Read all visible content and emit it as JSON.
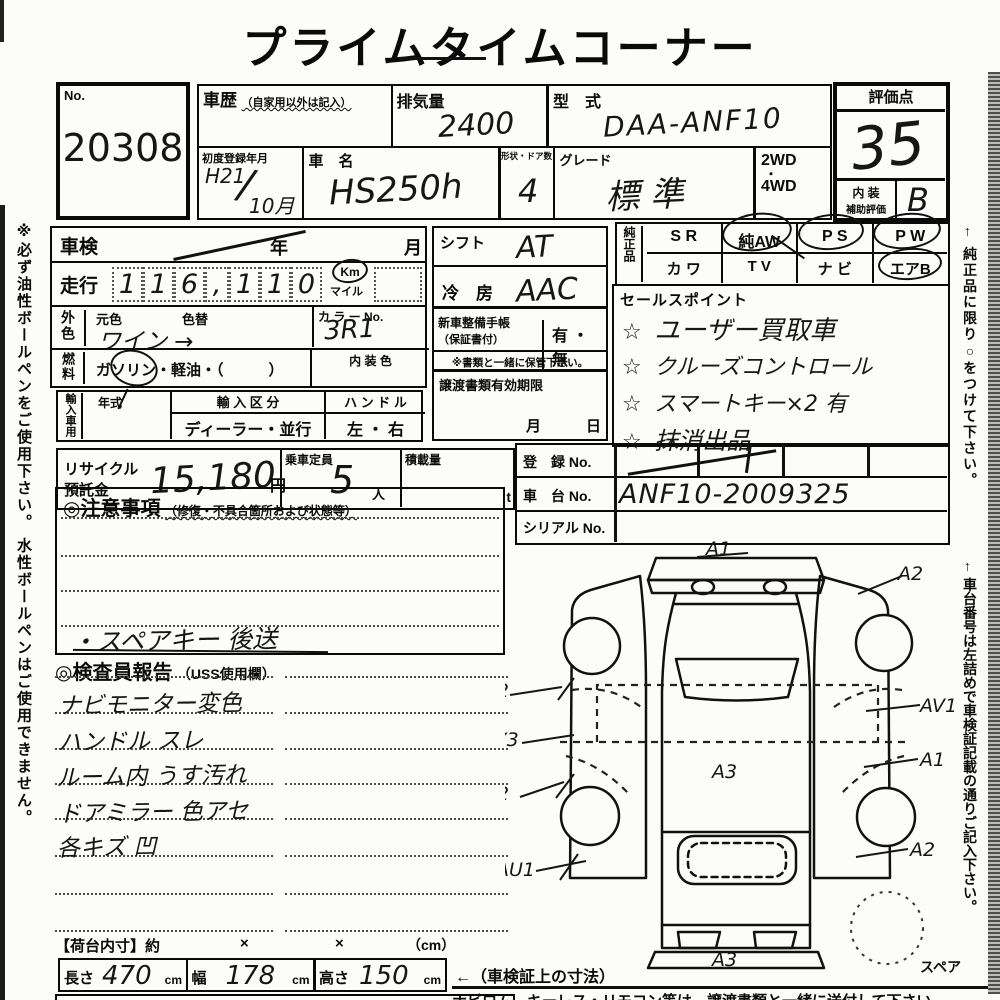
{
  "title": "プライムタイムコーナー",
  "side_notes": {
    "left": "※必ず油性ボールペンをご使用下さい。 水性ボールペンはご使用できません。",
    "right_genuine": "← 純正品に限り○をつけて下さい。",
    "right_chassis": "← 車台番号は左詰めで車検証記載の通りご記入下さい。"
  },
  "header": {
    "no_label": "No.",
    "no_value": "20308",
    "history_label": "車歴",
    "history_note": "（自家用以外は記入）",
    "displacement_label": "排気量",
    "displacement_value": "2400",
    "model_code_label": "型　式",
    "model_code_value": "DAA-ANF10",
    "first_reg_label": "初度登録年月",
    "first_reg_era_year": "H21",
    "first_reg_slash": "/",
    "first_reg_month": "10月",
    "car_name_label": "車　名",
    "car_name_value": "HS250h",
    "shape_doors_label": "形状・ドア数",
    "shape_doors_value": "4",
    "grade_label": "グレード",
    "grade_value": "標 準",
    "drive_top": "2WD",
    "drive_dot": "・",
    "drive_bottom": "4WD",
    "score_label": "評価点",
    "score_value": "35",
    "interior_label_line1": "内 装",
    "interior_label_line2": "補助評価",
    "interior_value": "B"
  },
  "left_panel": {
    "shaken_label": "車検",
    "year_label": "年",
    "month_label": "月",
    "mileage_label": "走行",
    "digits": [
      "1",
      "1",
      "6",
      ",",
      "1",
      "1",
      "0"
    ],
    "km_label": "Km",
    "mile_label": "マイル",
    "ext_color_label": "外色",
    "base_color_label": "元色",
    "base_color_value": "ワイン →",
    "color_change_label": "色替",
    "color_no_label": "カ ラ ー No.",
    "color_no_value": "3R1",
    "fuel_label": "燃料",
    "fuel_options": "ガソリン・軽油・（　　　）",
    "interior_color_label": "内 装 色",
    "import_label": "輸入車用",
    "year_type_label": "年式",
    "import_class_label": "輸 入 区 分",
    "import_class_value": "ディーラー・並行",
    "handle_label": "ハ ン ド ル",
    "handle_value": "左 ・ 右",
    "recycle_label_line1": "リサイクル",
    "recycle_label_line2": "預託金",
    "recycle_value": "15,180",
    "recycle_unit": "円",
    "capacity_label": "乗車定員",
    "capacity_value": "5",
    "capacity_unit": "人",
    "load_label": "積載量",
    "load_unit": "t"
  },
  "mid_panel": {
    "shift_label": "シフト",
    "shift_value": "AT",
    "ac_label": "冷　房",
    "ac_value": "AAC",
    "booklet_label": "新車整備手帳",
    "booklet_note": "（保証書付）",
    "booklet_value": "有 ・ 無",
    "keep_note": "※書類と一緒に保管下さい。",
    "transfer_label": "譲渡書類有効期限",
    "transfer_month": "月",
    "transfer_day": "日"
  },
  "genuine": {
    "label": "純正品",
    "row1": [
      "S R",
      "純AW",
      "P S",
      "P W"
    ],
    "row2": [
      "カ ワ",
      "T V",
      "ナ ビ",
      "エアB"
    ],
    "circled": [
      "純AW",
      "P S",
      "P W",
      "エアB"
    ]
  },
  "sales": {
    "label": "セールスポイント",
    "star": "☆",
    "items": [
      "ユーザー買取車",
      "クルーズコントロール",
      "スマートキー×2 有",
      "抹消出品"
    ]
  },
  "registration": {
    "reg_label": "登　録 No.",
    "chassis_label": "車　台 No.",
    "chassis_value": "ANF10-2009325",
    "serial_label": "シリアル No."
  },
  "notes": {
    "header": "◎注意事項",
    "header_note": "（修復・不具合箇所および状態等）",
    "entry": "・スペアキー 後送"
  },
  "inspector": {
    "header": "◎検査員報告",
    "header_note": "（USS使用欄）",
    "entries": [
      "ナビモニター変色",
      "ハンドル スレ",
      "ルーム内 うす汚れ",
      "ドアミラー 色アセ",
      "各キズ 凹"
    ]
  },
  "diagram": {
    "top_label": "A1",
    "center_label": "A3",
    "bottom_label": "A3",
    "left_labels": [
      "AU2",
      "AY3",
      "A2",
      "AU1"
    ],
    "right_labels": [
      "A2",
      "AV1",
      "A1",
      "A2"
    ],
    "spare_label": "スペア"
  },
  "cargo": {
    "header": "【荷台内寸】約",
    "x1": "×",
    "x2": "×",
    "unit": "（cm）",
    "length_label": "長さ",
    "length_value": "470",
    "width_label": "幅",
    "width_value": "178",
    "height_label": "高さ",
    "height_value": "150",
    "cm": "cm",
    "note": "←（車検証上の寸法）"
  },
  "footer": "ナビロム、キーレス・リモコン等は、譲渡書類と一緒に送付して下さい"
}
